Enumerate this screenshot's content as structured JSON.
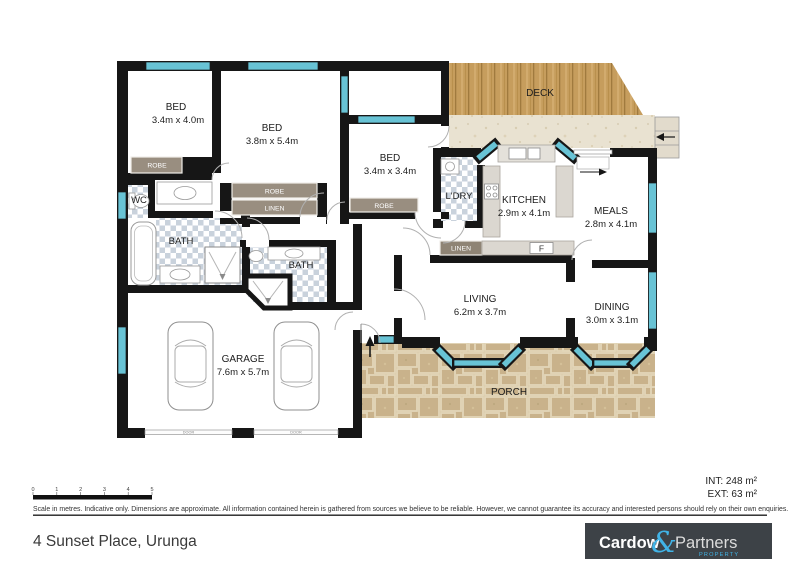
{
  "rooms": {
    "bed1": {
      "name": "BED",
      "dims": "3.4m x 4.0m"
    },
    "bed2": {
      "name": "BED",
      "dims": "3.8m x 5.4m"
    },
    "bed3": {
      "name": "BED",
      "dims": "3.4m x 3.4m"
    },
    "wc": {
      "name": "WC"
    },
    "bath1": {
      "name": "BATH"
    },
    "bath2": {
      "name": "BATH"
    },
    "laundry": {
      "name": "L'DRY"
    },
    "kitchen": {
      "name": "KITCHEN",
      "dims": "2.9m x 4.1m"
    },
    "meals": {
      "name": "MEALS",
      "dims": "2.8m x 4.1m"
    },
    "living": {
      "name": "LIVING",
      "dims": "6.2m x 3.7m"
    },
    "dining": {
      "name": "DINING",
      "dims": "3.0m x 3.1m"
    },
    "garage": {
      "name": "GARAGE",
      "dims": "7.6m x 5.7m"
    },
    "deck": {
      "name": "DECK"
    },
    "porch": {
      "name": "PORCH"
    }
  },
  "fixtures": {
    "robe1": "ROBE",
    "robe2": "ROBE",
    "linen1": "LINEN",
    "robe3": "ROBE",
    "linen2": "LINEN",
    "fridge": "F",
    "garage_door1": "DOOR",
    "garage_door2": "DOOR"
  },
  "scale_bar": {
    "unit_labels": [
      "0",
      "1",
      "2",
      "3",
      "4",
      "5"
    ]
  },
  "areas": {
    "internal": "INT: 248 m²",
    "external": "EXT: 63 m²"
  },
  "footer": {
    "disclaimer": "Scale in metres. Indicative only. Dimensions are approximate. All information contained herein is gathered from sources we believe to be reliable. However, we cannot guarantee its accuracy and interested persons should rely on their own enquiries.",
    "address": "4 Sunset Place, Urunga"
  },
  "logo": {
    "name": "Cardow",
    "ampersand": "&",
    "partners": "Partners",
    "tagline": "PROPERTY"
  },
  "colors": {
    "wall": "#161616",
    "window": "#68c3d5",
    "deck_wood": "#c69d5d",
    "porch_stone": "#c9b28b",
    "stucco": "#e9e2d1",
    "tile": "#c9d2dc",
    "logo_bg": "#3d4247",
    "logo_accent": "#41b3e6"
  }
}
